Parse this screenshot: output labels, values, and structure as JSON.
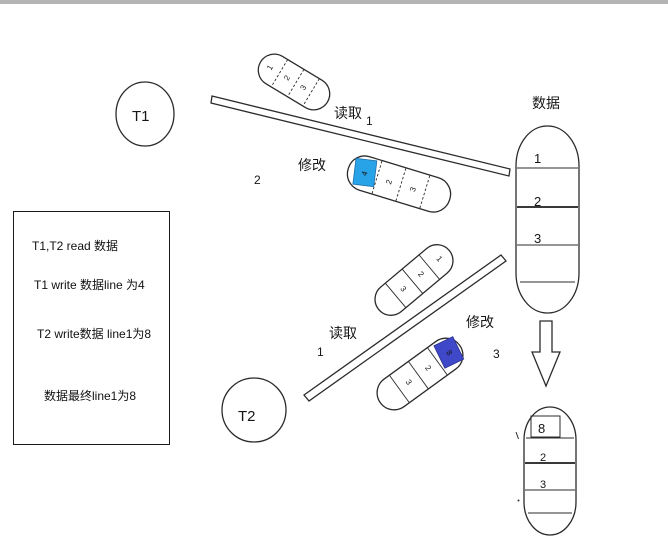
{
  "colors": {
    "t1_write_highlight": "#29a3e8",
    "t2_write_highlight": "#3f48c8"
  },
  "nodes": {
    "t1": "T1",
    "t2": "T2"
  },
  "store": {
    "title": "数据",
    "rows": [
      "1",
      "2",
      "3"
    ]
  },
  "edges": {
    "t1_read": {
      "label": "读取",
      "step": "1"
    },
    "t1_write": {
      "label": "修改",
      "step": "2"
    },
    "t2_read": {
      "label": "读取",
      "step": "1"
    },
    "t2_write": {
      "label": "修改",
      "step": "3"
    }
  },
  "copies": {
    "t1_read_copy": {
      "cells": [
        "1",
        "2",
        "3"
      ]
    },
    "t1_write_copy": {
      "cells": [
        "4",
        "2",
        "3"
      ]
    },
    "t2_read_copy": {
      "cells": [
        "1",
        "2",
        "3"
      ]
    },
    "t2_write_copy": {
      "cells": [
        "8",
        "2",
        "3"
      ]
    }
  },
  "final_store": {
    "rows": [
      "8",
      "2",
      "3"
    ]
  },
  "notes": [
    "T1,T2 read 数据",
    "T1 write 数据line 为4",
    "T2 write数据 line1为8",
    "数据最终line1为8"
  ]
}
